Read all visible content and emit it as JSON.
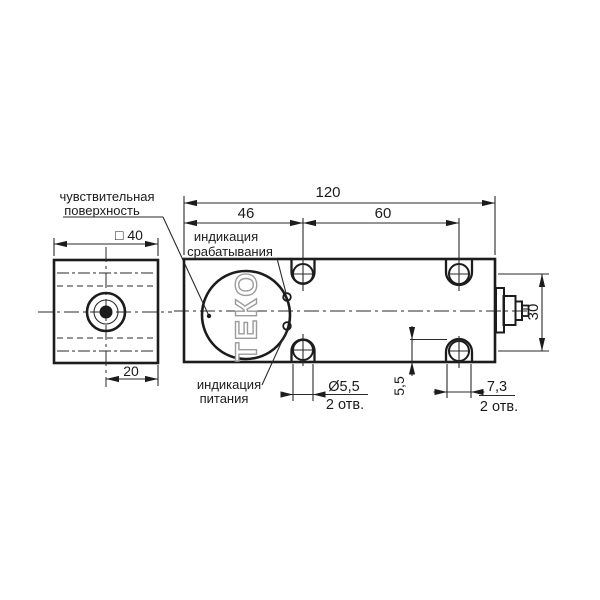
{
  "palette": {
    "background": "#ffffff",
    "line": "#1c1c1c",
    "logo_outline": "#9b9b9b"
  },
  "side_view": {
    "dim_square": "□ 40",
    "dim_offset": "20"
  },
  "front_view": {
    "dim_length": "120",
    "dim_hole_left": "46",
    "dim_hole_span": "60",
    "dim_height": "30",
    "dim_edge": "5,5",
    "dim_hole_dia": "Ø5,5",
    "dim_hole_dia_qty": "2 отв.",
    "dim_slot": "7,3",
    "dim_slot_qty": "2 отв.",
    "logo_text": "ТЕКО"
  },
  "callouts": {
    "sensitive_1": "чувствительная",
    "sensitive_2": "поверхность",
    "output_1": "индикация",
    "output_2": "срабатывания",
    "power_1": "индикация",
    "power_2": "питания"
  }
}
